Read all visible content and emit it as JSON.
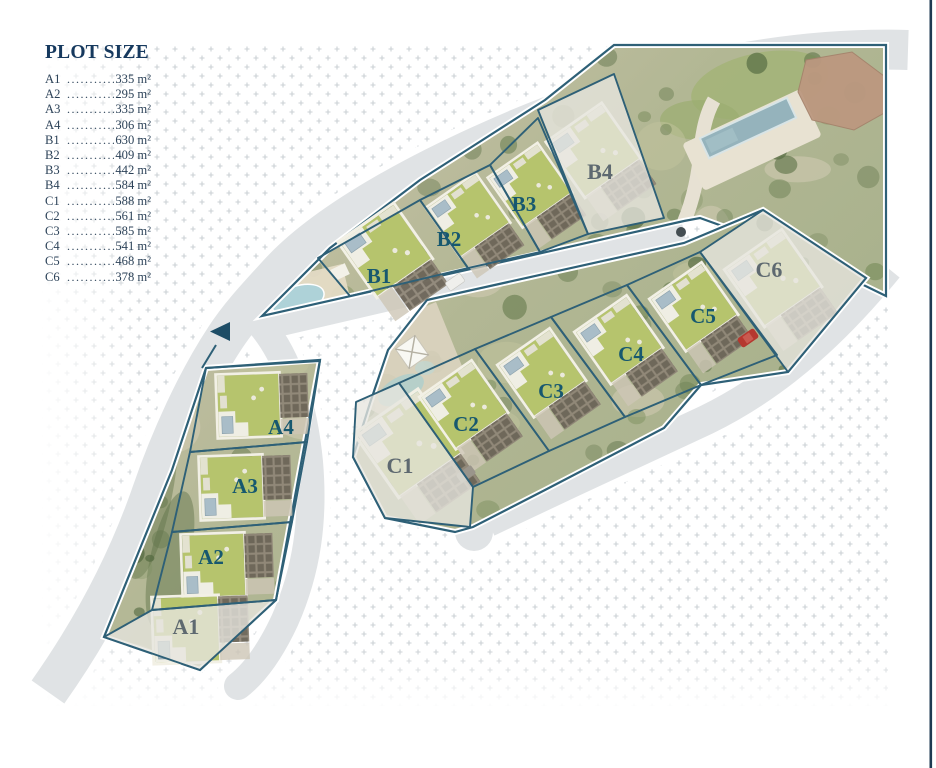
{
  "legend": {
    "title": "PLOT SIZE",
    "items": [
      {
        "id": "A1",
        "size": "335 m²"
      },
      {
        "id": "A2",
        "size": "295 m²"
      },
      {
        "id": "A3",
        "size": "335 m²"
      },
      {
        "id": "A4",
        "size": "306 m²"
      },
      {
        "id": "B1",
        "size": "630 m²"
      },
      {
        "id": "B2",
        "size": "409 m²"
      },
      {
        "id": "B3",
        "size": "442 m²"
      },
      {
        "id": "B4",
        "size": "584 m²"
      },
      {
        "id": "C1",
        "size": "588 m²"
      },
      {
        "id": "C2",
        "size": "561 m²"
      },
      {
        "id": "C3",
        "size": "585 m²"
      },
      {
        "id": "C4",
        "size": "541 m²"
      },
      {
        "id": "C5",
        "size": "468 m²"
      },
      {
        "id": "C6",
        "size": "378 m²"
      }
    ]
  },
  "map": {
    "plots": [
      {
        "id": "A1",
        "greyed_out": true
      },
      {
        "id": "A2",
        "greyed_out": false
      },
      {
        "id": "A3",
        "greyed_out": false
      },
      {
        "id": "A4",
        "greyed_out": false
      },
      {
        "id": "B1",
        "greyed_out": false
      },
      {
        "id": "B2",
        "greyed_out": false
      },
      {
        "id": "B3",
        "greyed_out": false
      },
      {
        "id": "B4",
        "greyed_out": true
      },
      {
        "id": "C1",
        "greyed_out": true
      },
      {
        "id": "C2",
        "greyed_out": false
      },
      {
        "id": "C3",
        "greyed_out": false
      },
      {
        "id": "C4",
        "greyed_out": false
      },
      {
        "id": "C5",
        "greyed_out": false
      },
      {
        "id": "C6",
        "greyed_out": true
      }
    ],
    "icons": [
      {
        "name": "entrance-arrow",
        "glyph": "left-triangle"
      }
    ],
    "colors": {
      "legend_title": "#16395e",
      "legend_text": "#2c4258",
      "label_available": "#17586f",
      "label_greyed": "#5e6970",
      "boundary": "#2e6077",
      "road": "#e0e3e5",
      "pattern_dots": "#cbd0d4",
      "garden_green": "#b6c46d",
      "pool_blue": "#aed2d8",
      "arrow": "#1d4d66",
      "page_edge": "#1d3a52",
      "greyed_overlay": "#e7e5df"
    }
  }
}
